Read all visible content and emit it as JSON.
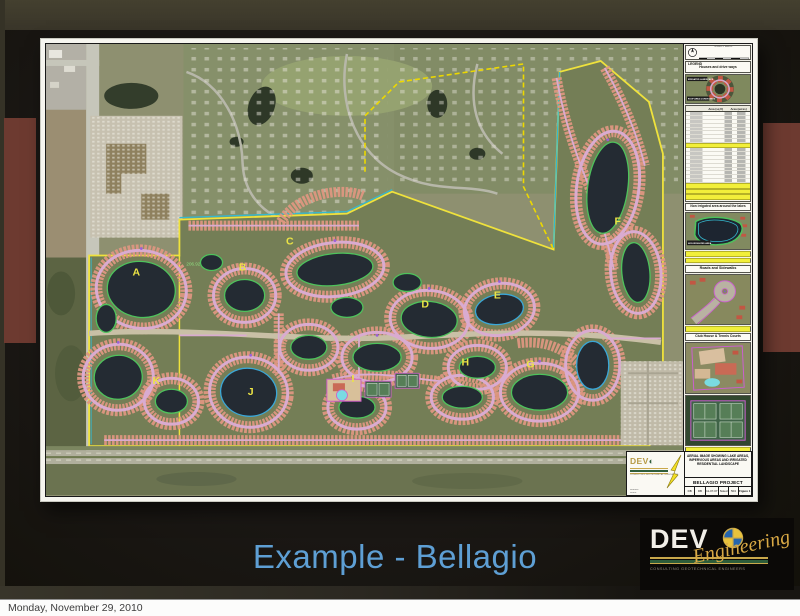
{
  "window": {
    "status_date": "Monday, November 29, 2010"
  },
  "slide": {
    "title": "Example - Bellagio",
    "logo": {
      "wordmark": "DEV",
      "script": "Engineering",
      "tagline": "CONSULTING GEOTECHNICAL ENGINEERS"
    },
    "colors": {
      "title_blue": "#5e9fd4",
      "band_maroon": "#6d3a30",
      "band_olive": "#3b382c",
      "logo_gold": "#d9a945"
    }
  },
  "sheet": {
    "scale_box": {
      "title": "GRAPHIC SCALE",
      "subtitle": "1 inch = 300 ft."
    },
    "legend": {
      "title": "LEGEND",
      "subtitle": "Houses and drive ways",
      "thumb_label_top": "IRRIGATED LANDSCAPE",
      "thumb_label_bottom": "ROOF AREA & DRIVE WAYS",
      "col_area_sqft": "Area (sq ft)",
      "col_area_acres": "Area (acres)",
      "section_lakes": "Non irrigated area around the lakes",
      "lake_thumb_label": "NON IRRIGATED AREA",
      "section_roads": "Roads and Sidewalks",
      "section_club": "Club House & Tennis Courts"
    },
    "title_block": {
      "description": "AERIAL IMAGE SHOWING LAKE AREAS, IMPERVIOUS AREAS AND IRRIGATED RESIDENTIAL LANDSCAPE",
      "project": "BELLAGIO PROJECT",
      "drawn": "DB",
      "checked": "DB",
      "date": "11-07-07",
      "scale": "Noted",
      "job": "504",
      "figure": "Figure 1"
    }
  },
  "map": {
    "labels": [
      "A",
      "B",
      "C",
      "D",
      "E",
      "F",
      "G",
      "H",
      "I",
      "J",
      "K"
    ],
    "annotation": "206.92",
    "colors": {
      "boundary_yellow": "#efe23c",
      "lake_outline_green": "#4ec35c",
      "road_pink": "#d9abd0",
      "houses_salmon": "#dd9781",
      "canal_cyan": "#35b9cf"
    }
  }
}
